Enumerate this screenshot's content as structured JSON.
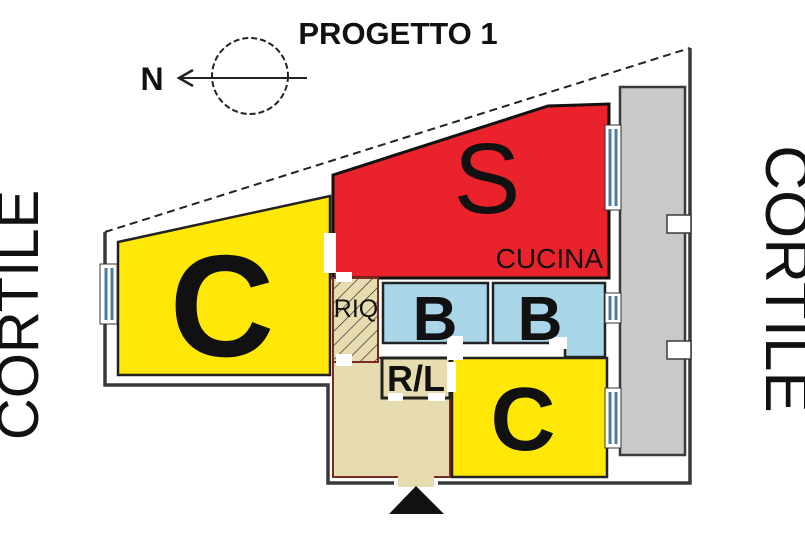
{
  "title": "PROGETTO 1",
  "compass": {
    "north_label": "N"
  },
  "courtyards": {
    "left_label": "CORTILE",
    "right_label": "CORTILE"
  },
  "rooms": {
    "c_left": {
      "label": "C"
    },
    "soggiorno": {
      "label": "S"
    },
    "cucina": {
      "label": "CUCINA"
    },
    "riq": {
      "label": "RIQ"
    },
    "b1": {
      "label": "B"
    },
    "b2": {
      "label": "B"
    },
    "rl": {
      "label": "R/L"
    },
    "c_right": {
      "label": "C"
    }
  },
  "colors": {
    "red": "#e9222b",
    "yellow": "#ffe808",
    "blue": "#a9d6e8",
    "tan": "#e6dcb0",
    "gray": "#c9c9c9",
    "wall_dark": "#3a3a3a",
    "partition_red": "#7b2a22",
    "window_blue": "#4d7d9e",
    "entrance_black": "#111111"
  }
}
